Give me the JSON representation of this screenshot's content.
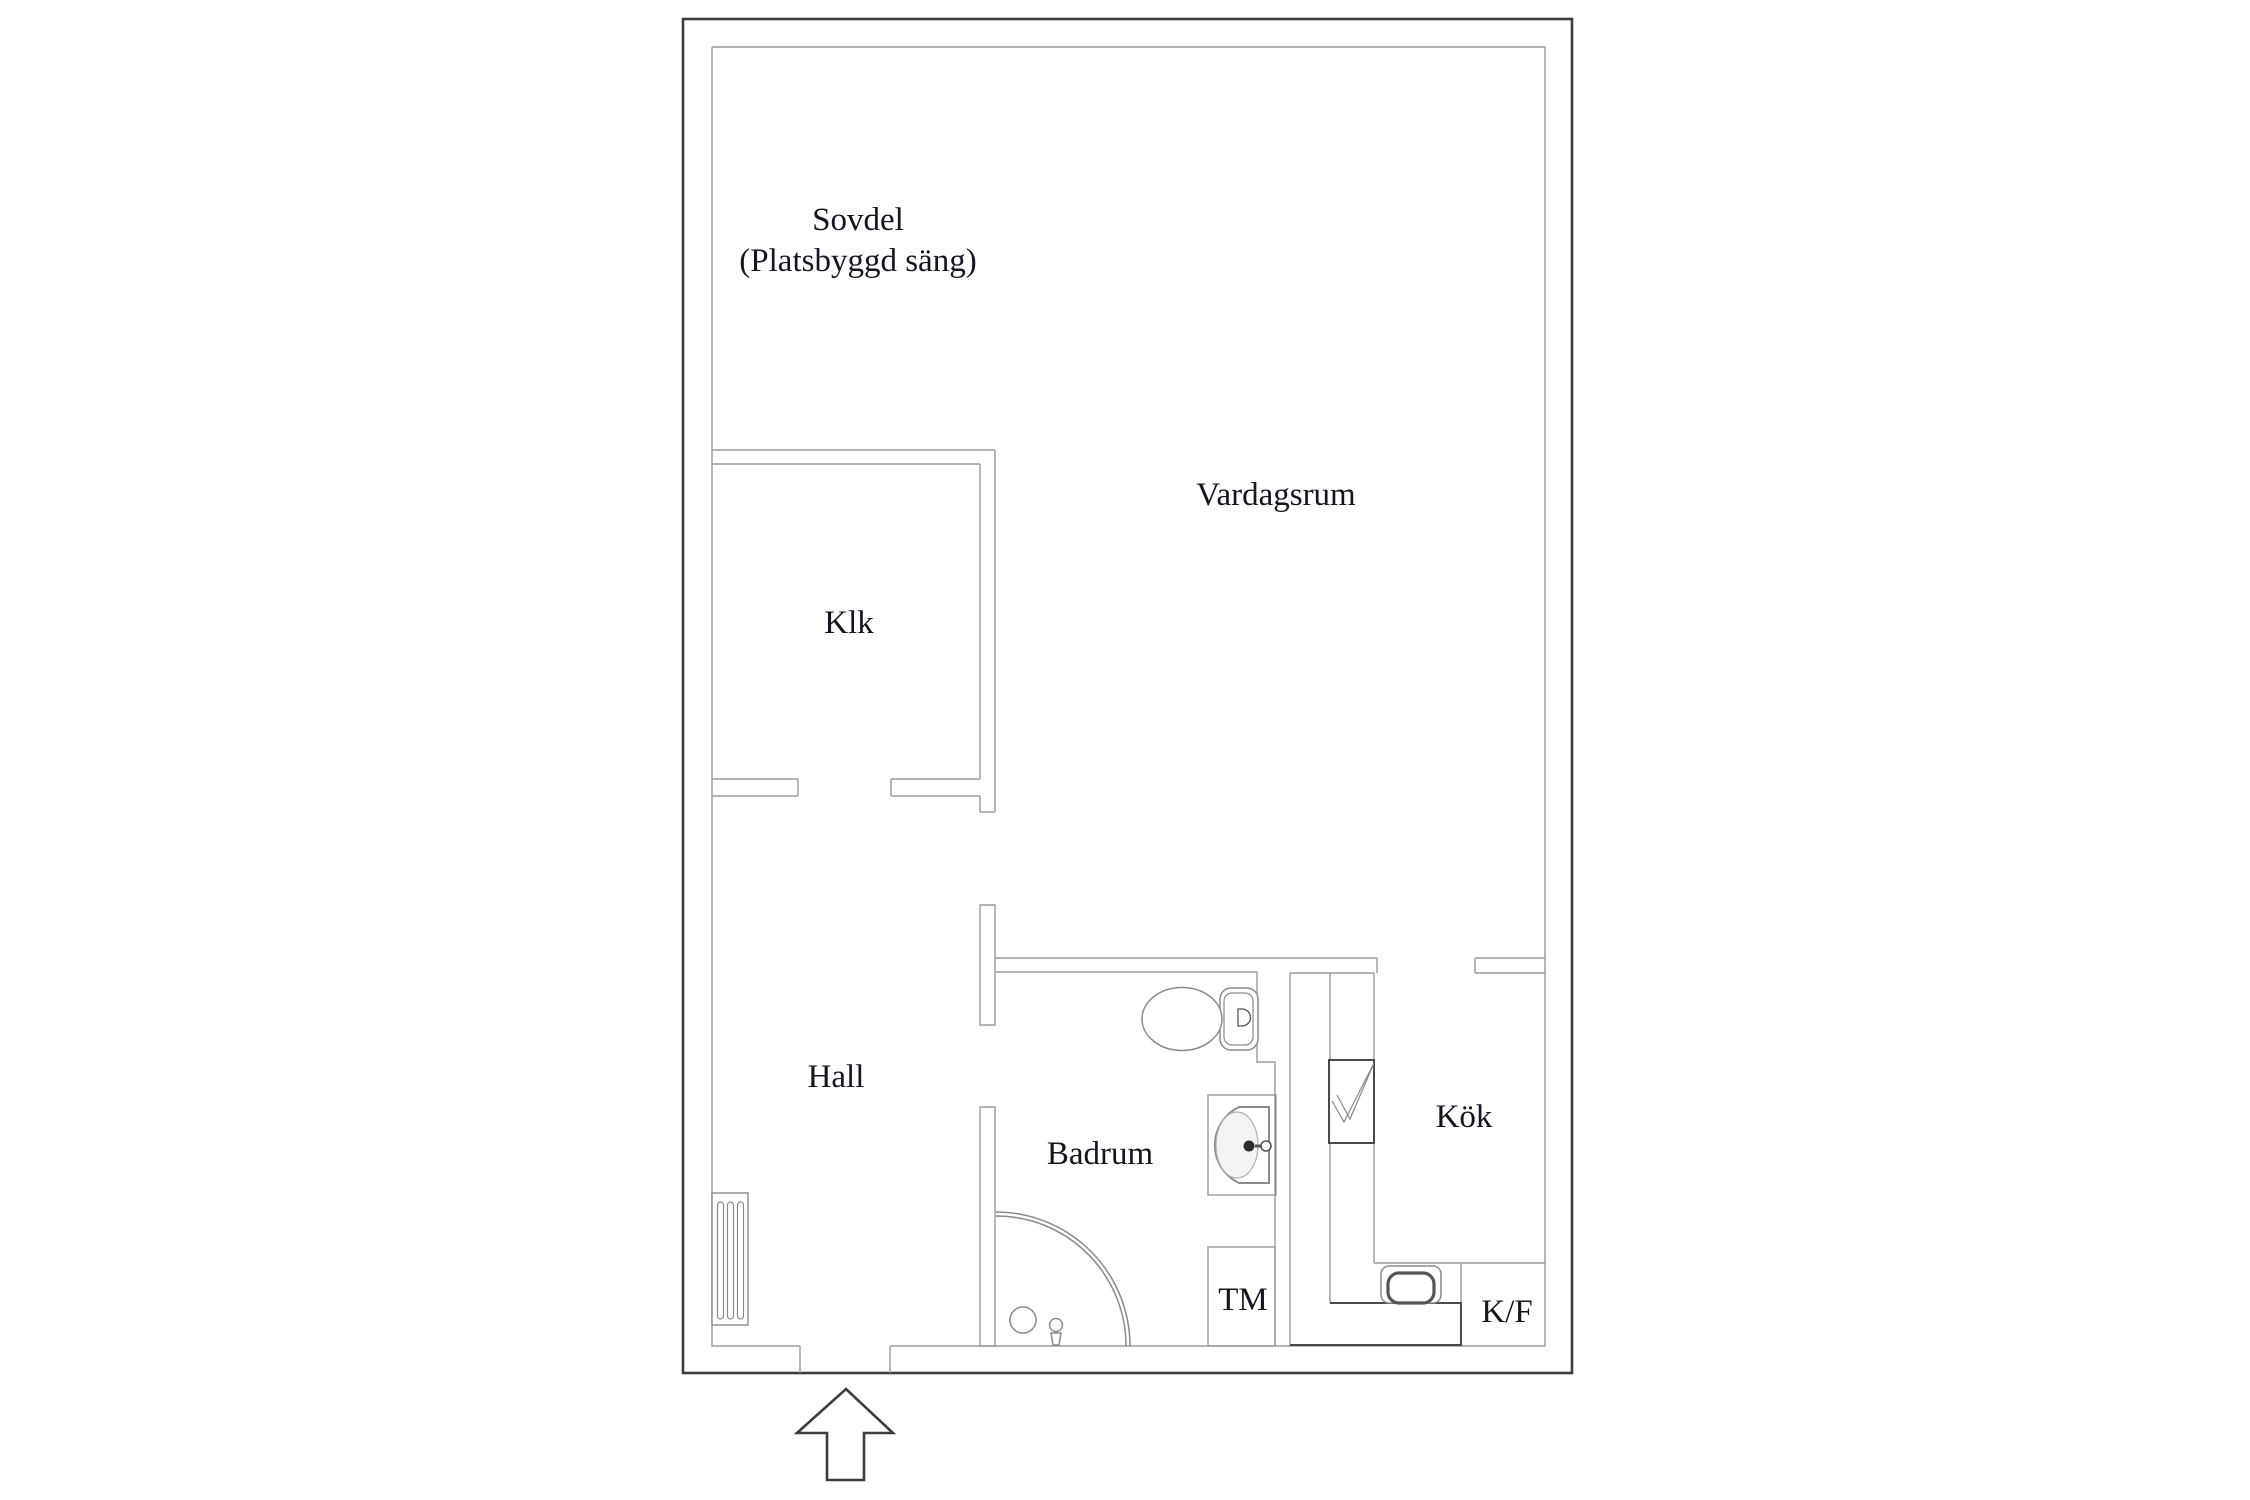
{
  "floorplan": {
    "type": "apartment-floor-plan",
    "labels": {
      "sovdel_line1": "Sovdel",
      "sovdel_line2": "(Platsbyggd säng)",
      "vardagsrum": "Vardagsrum",
      "klk": "Klk",
      "hall": "Hall",
      "badrum": "Badrum",
      "tm": "TM",
      "kok": "Kök",
      "kf": "K/F"
    },
    "colors": {
      "outer_wall": "#3d3d3d",
      "inner_wall": "#9a9a9a",
      "fixture": "#8a8a8a",
      "counter": "#4a4a4a",
      "text": "#15151f",
      "background": "#ffffff"
    },
    "icons": {
      "entrance_arrow": "up-arrow",
      "stove_symbol": "checkmark-square",
      "radiator_symbol": "slotted-rectangle"
    }
  }
}
